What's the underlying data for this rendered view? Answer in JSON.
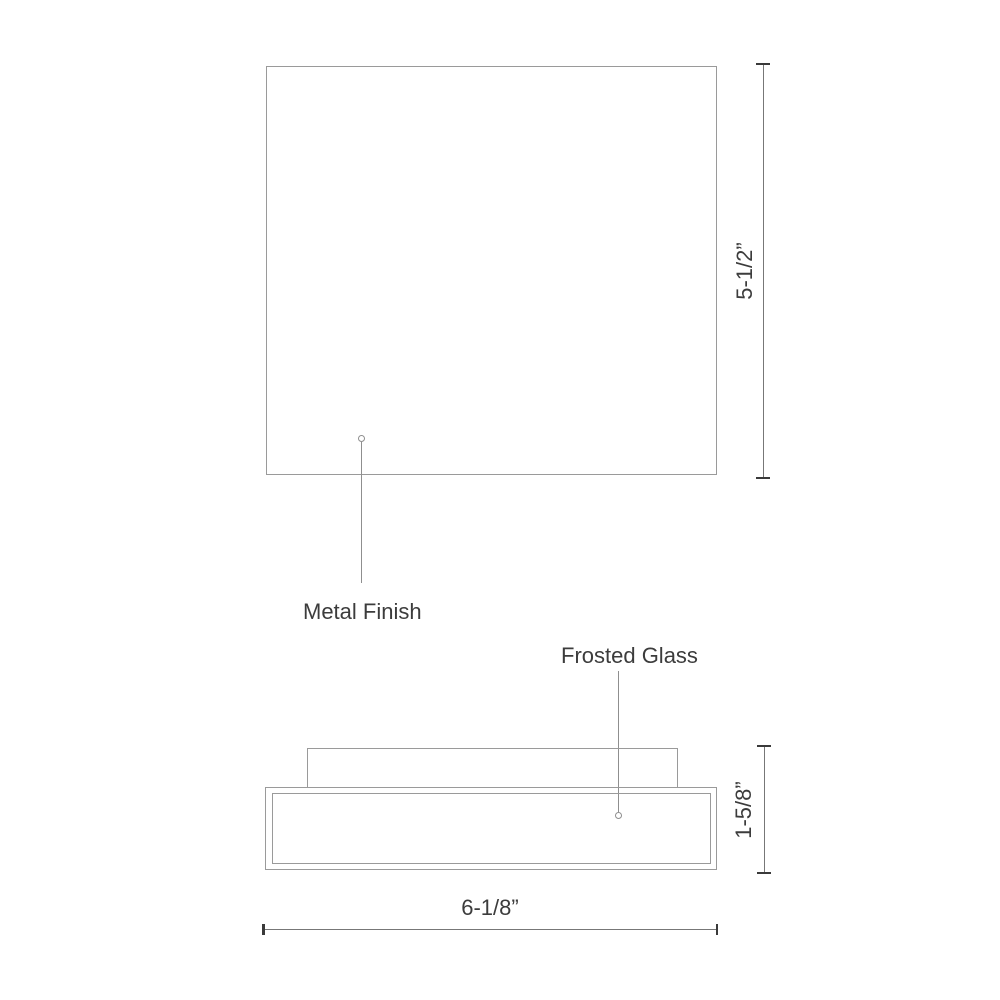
{
  "callouts": {
    "metal_finish": {
      "label": "Metal Finish"
    },
    "frosted_glass": {
      "label": "Frosted Glass"
    }
  },
  "dimensions": {
    "overall_height": {
      "label": "5-1/2”"
    },
    "fixture_depth": {
      "label": "1-5/8”"
    },
    "overall_width": {
      "label": "6-1/8”"
    }
  },
  "colors": {
    "background": "#ffffff",
    "outline": "#9a9a9a",
    "leader": "#8f8f8f",
    "dimension_line": "#777777",
    "tick": "#3a3a3a",
    "text": "#3c3c3c"
  }
}
